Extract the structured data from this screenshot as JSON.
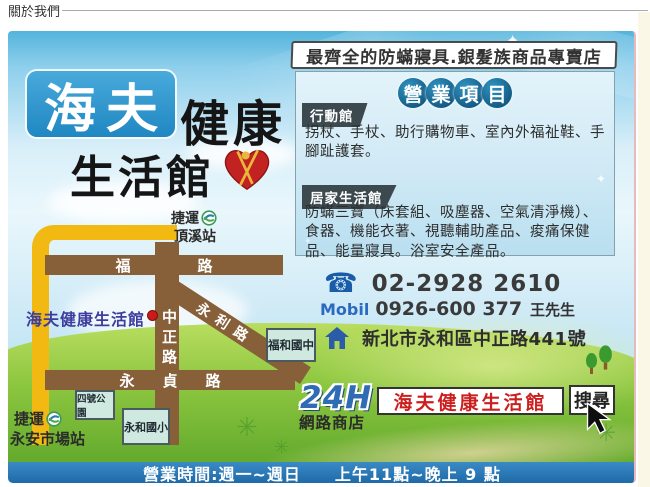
{
  "page": {
    "about_label": "關於我們"
  },
  "logo": {
    "part1": "海夫",
    "part2": "健康",
    "part3": "生活館"
  },
  "banner": {
    "text": "最齊全的防蟎寢具.銀髮族商品專賣店"
  },
  "business": {
    "title_chars": [
      "營",
      "業",
      "項",
      "目"
    ],
    "sections": [
      {
        "label": "行動館",
        "text": "拐杖、手杖、助行購物車、室內外福祉鞋、手腳趾護套。"
      },
      {
        "label": "居家生活館",
        "text": "防蟎三寶（床套組、吸塵器、空氣清淨機）、食器、機能衣著、視聽輔助產品、痠痛保健品、能量寢具。浴室安全產品。"
      }
    ]
  },
  "contact": {
    "phone": "02-2928 2610",
    "mobile_label": "Mobil",
    "mobile": "0926-600 377",
    "contact_person": "王先生",
    "address": "新北市永和區中正路441號"
  },
  "shop": {
    "badge_line1": "24H",
    "badge_line2": "網路商店",
    "search_value": "海夫健康生活館",
    "search_button_label": "搜尋"
  },
  "map": {
    "station_top": {
      "line1": "捷運",
      "line2": "頂溪站"
    },
    "station_bottom": {
      "line1": "捷運",
      "line2": "永安市場站"
    },
    "roads": {
      "fuhe": "福和路",
      "zhongzheng": "中正路",
      "yongli": "永利路",
      "yongzhen": "永貞路"
    },
    "places": {
      "park": "四號公園",
      "school1": "永和國小",
      "school2": "福和國中"
    },
    "store_marker": "海夫健康生活館"
  },
  "footer": {
    "left": "營業時間:週一~週日",
    "right": "上午11點~晚上 9 點"
  },
  "icons": {
    "phone": "☎"
  },
  "colors": {
    "road_brown": "#87603A",
    "road_yellow": "#F1B912",
    "footer_blue": "#2B7CB8",
    "logo_blue": "#2E96CC",
    "search_text_red": "#CC2020",
    "store_label_blue": "#3D3D9E",
    "badge_dark": "#3C4A50",
    "circle_blue": "#135A84"
  }
}
